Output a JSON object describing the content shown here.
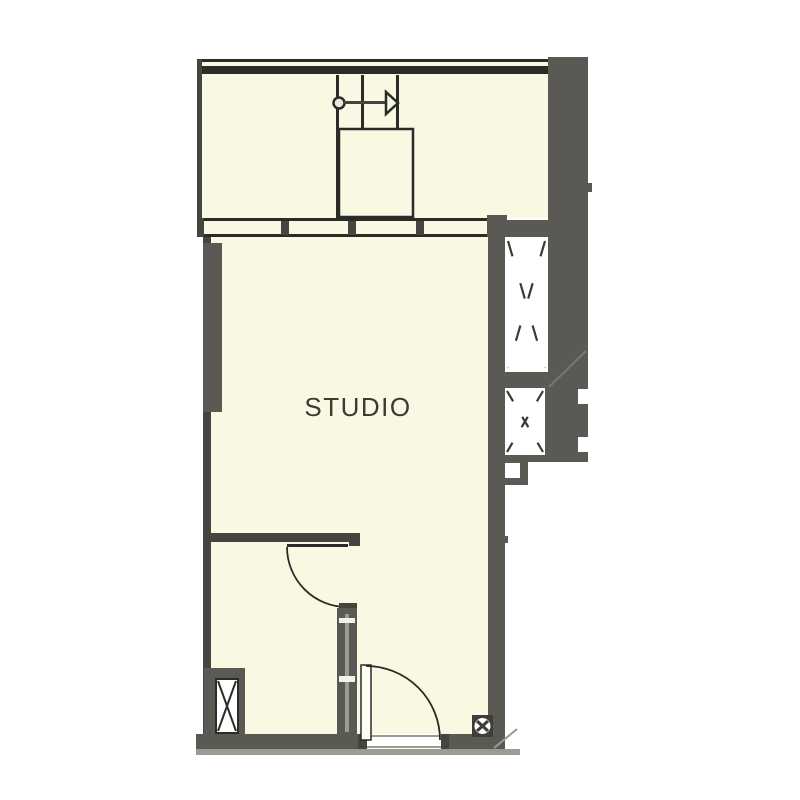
{
  "labels": {
    "studio_room": "STUDIO"
  },
  "colors": {
    "background": "#ffffff",
    "room_fill": "#f8f8e3",
    "wall": "#5a5954",
    "wall_dark": "#45443f",
    "line": "#2b2b27",
    "light_gray": "#9c9b91",
    "text": "#3b3b35"
  },
  "symbols": {
    "shaft-x-icon": "dashed ✕ (vertical shaft/void)",
    "column-x-icon": "solid ✕ in white box (structural column)",
    "survey-marker-icon": "⊠ circle with cross in dark square",
    "door-swing-arc": "quarter-circle arc with leaf line",
    "balcony-fixture-arrow-icon": "▷ open triangle with stem and circle"
  }
}
